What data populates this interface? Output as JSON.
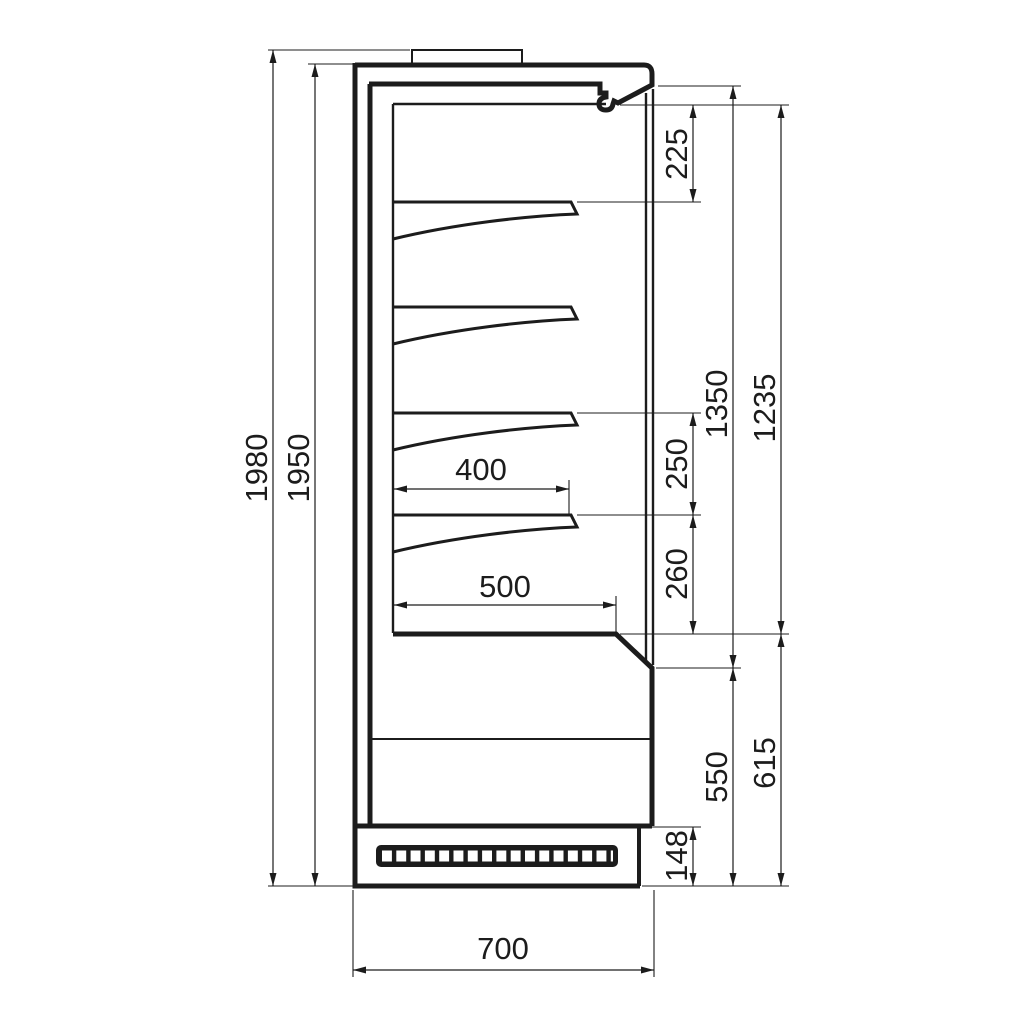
{
  "drawing": {
    "background": "#ffffff",
    "line_color": "#1c1c1c",
    "unit": "mm",
    "dims": {
      "overall_height": "1980",
      "body_height": "1950",
      "canopy_to_shelf": "225",
      "opening_height": "1350",
      "display_height": "1235",
      "shelf_spacing_upper": "250",
      "shelf_spacing_lower": "260",
      "deck_height": "615",
      "lower_front_height": "550",
      "plinth_height": "148",
      "shelf_depth": "400",
      "deck_depth": "500",
      "overall_depth": "700"
    }
  }
}
